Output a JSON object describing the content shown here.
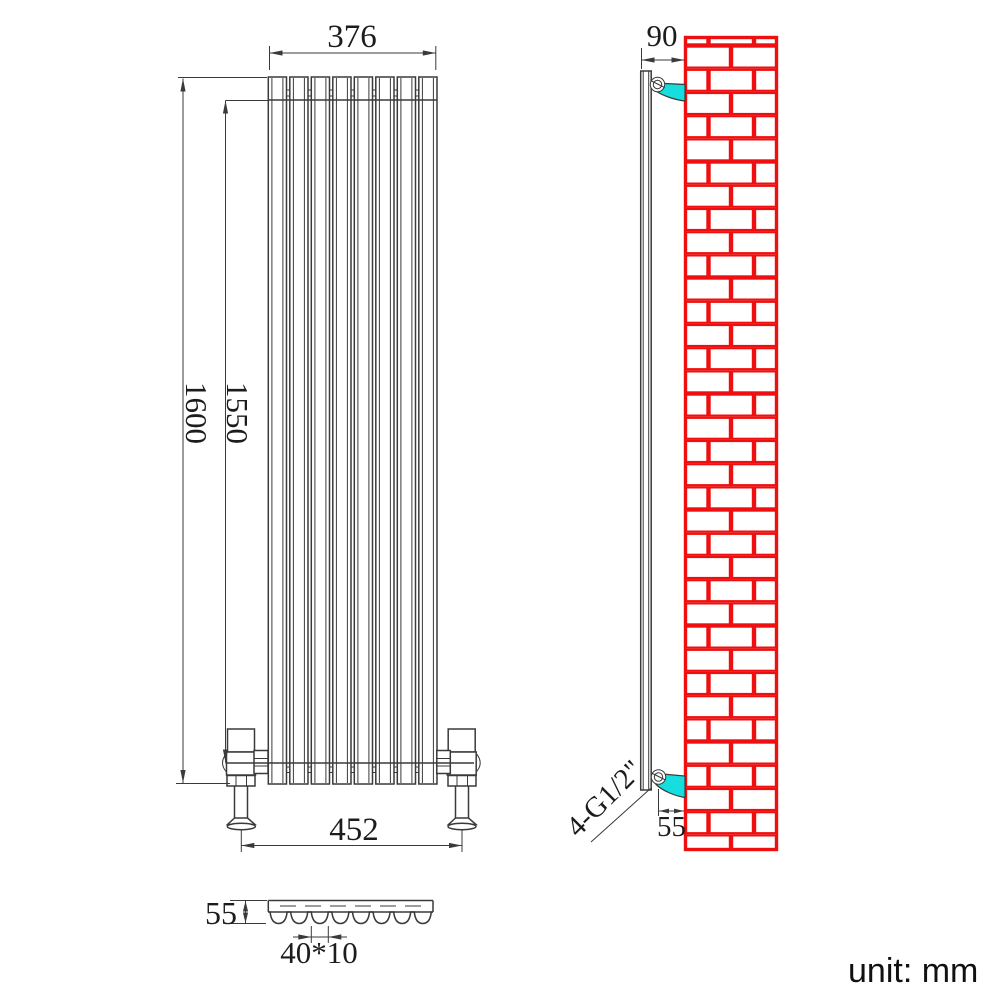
{
  "title": "Vertical radiator dimension drawing",
  "unit_label": "unit: mm",
  "front_view": {
    "panel_count": 8,
    "width_top": "376",
    "height_overall": "1600",
    "height_inner": "1550",
    "valve_centres": "452"
  },
  "section_view": {
    "depth": "55",
    "panel_section": "40*10"
  },
  "side_view": {
    "wall_distance": "90",
    "bracket_offset": "55",
    "connections": "4-G1/2\""
  },
  "colors": {
    "line": "#3a3a3a",
    "ink": "#1c1c1c",
    "brick": "#ee1010",
    "bracket": "#16dede"
  }
}
